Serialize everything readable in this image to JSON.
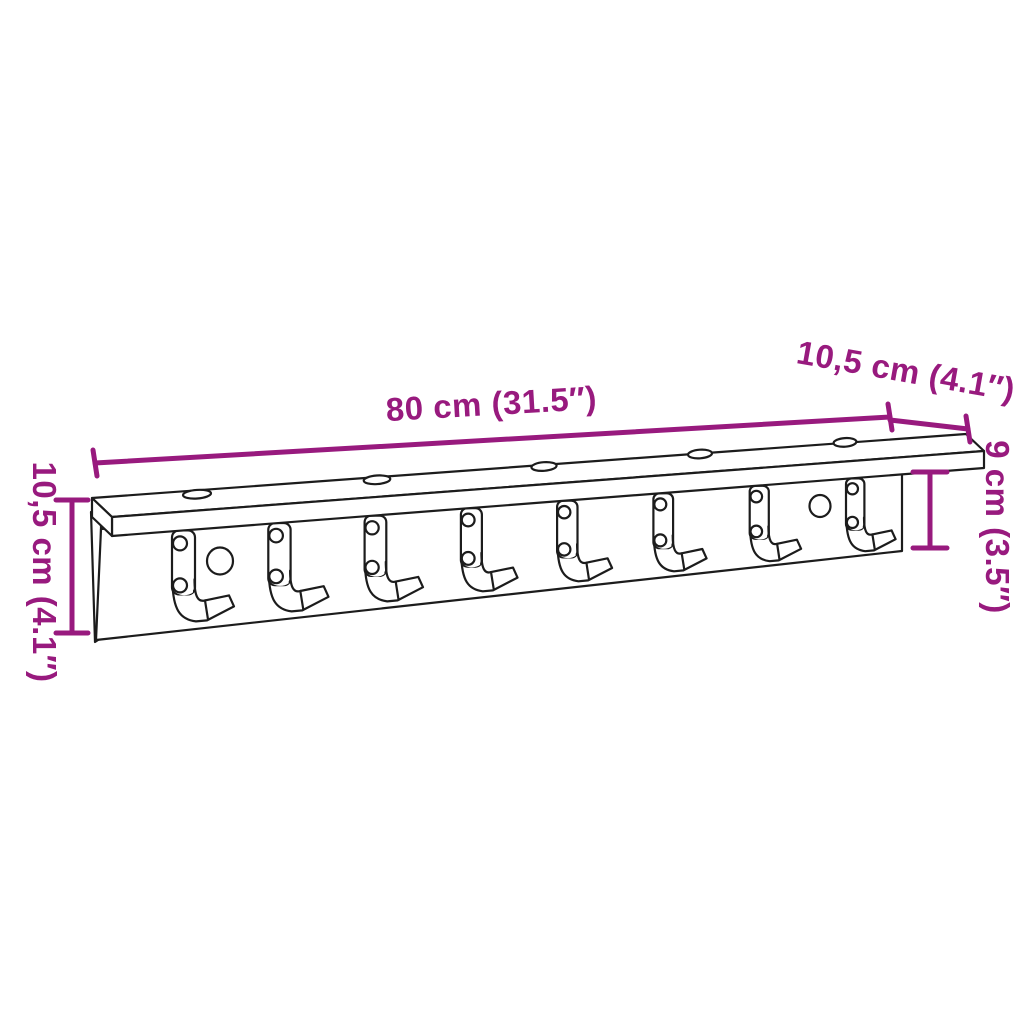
{
  "diagram": {
    "type": "product-dimension-diagram",
    "product": "wall-mounted coat rack with shelf and hooks",
    "background_color": "#ffffff",
    "line_color": "#1c1c1c",
    "dimension_color": "#981a7e",
    "hook_count": 8,
    "shelf_screw_hole_count": 5,
    "panel_hole_count": 2,
    "dimensions": {
      "length": {
        "label": "80 cm (31.5″)"
      },
      "depth": {
        "label": "10,5 cm (4.1″)"
      },
      "height_right": {
        "label": "9 cm (3.5″)"
      },
      "height_left": {
        "label": "10,5 cm (4.1″)"
      }
    }
  }
}
